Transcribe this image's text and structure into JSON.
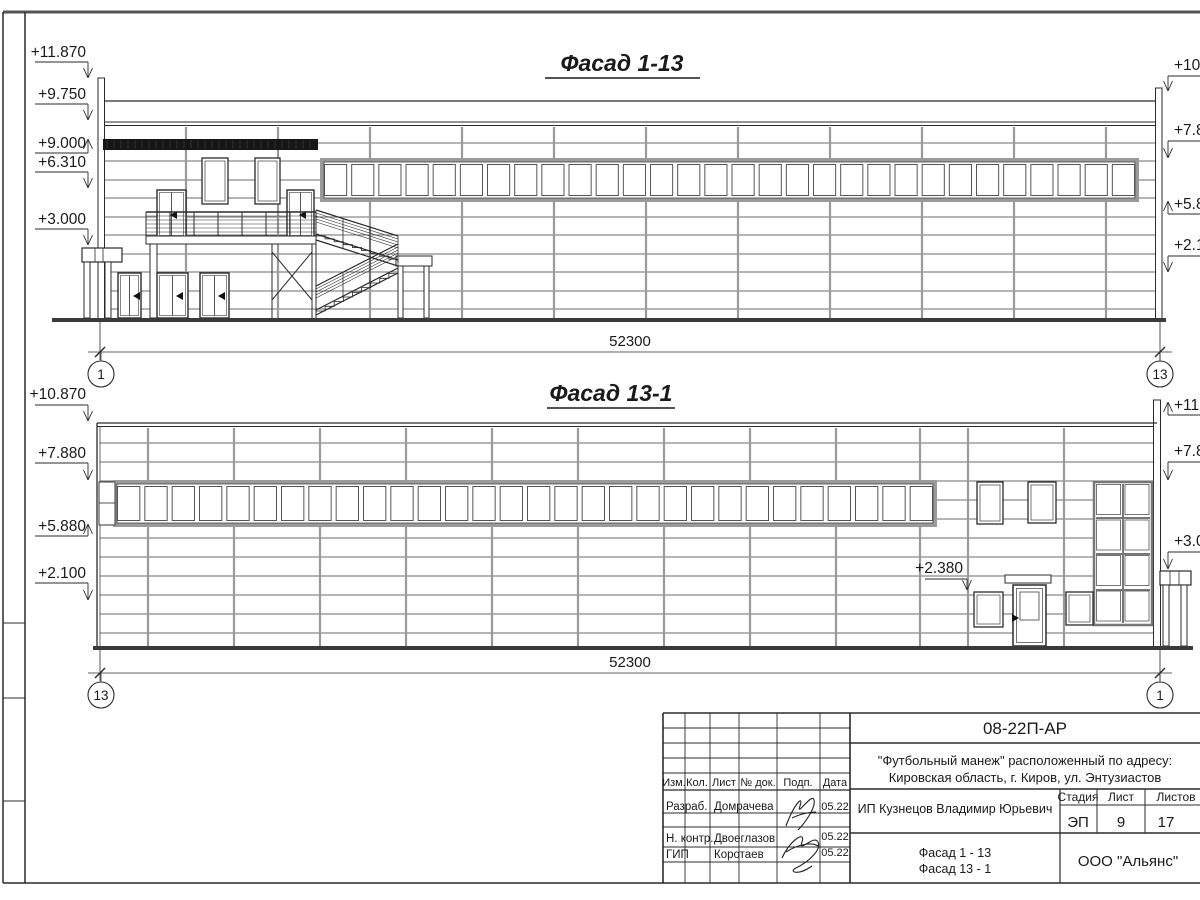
{
  "sheet": {
    "title_f1": "Фасад 1-13",
    "title_f2": "Фасад 13-1"
  },
  "dimensions": {
    "f1_total": "52300",
    "f2_total": "52300"
  },
  "axes": {
    "f1_left": "1",
    "f1_right": "13",
    "f2_left": "13",
    "f2_right": "1"
  },
  "marks": {
    "f1_left": [
      "+11.870",
      "+9.750",
      "+9.000",
      "+6.310",
      "+3.000"
    ],
    "f1_right": [
      "+10.8",
      "+7.8",
      "+5.8",
      "+2.1"
    ],
    "f2_left": [
      "+10.870",
      "+7.880",
      "+5.880",
      "+2.100"
    ],
    "f2_mid": "+2.380",
    "f2_right": [
      "+11.8",
      "+7.8",
      "+3.0"
    ]
  },
  "title_block": {
    "doc_number": "08-22П-АР",
    "project_line1": "\"Футбольный манеж\" расположенный по адресу:",
    "project_line2": "Кировская область, г. Киров, ул. Энтузиастов",
    "col_izm": "Изм.",
    "col_kol": "Кол.",
    "col_list": "Лист",
    "col_doc": "№ док.",
    "col_podp": "Подп.",
    "col_data": "Дата",
    "row1_role": "Разраб.",
    "row1_name": "Домрачева",
    "row1_date": "05.22",
    "row2_role": "Н. контр.",
    "row2_name": "Двоеглазов",
    "row2_date": "05.22",
    "row3_role": "ГИП",
    "row3_name": "Коротаев",
    "row3_date": "05.22",
    "client": "ИП Кузнецов Владимир Юрьевич",
    "stage_label": "Стадия",
    "sheet_label": "Лист",
    "sheets_label": "Листов",
    "stage": "ЭП",
    "sheet_no": "9",
    "sheets_total": "17",
    "sheet_title_line1": "Фасад 1 - 13",
    "sheet_title_line2": "Фасад 13 - 1",
    "company": "ООО \"Альянс\""
  }
}
